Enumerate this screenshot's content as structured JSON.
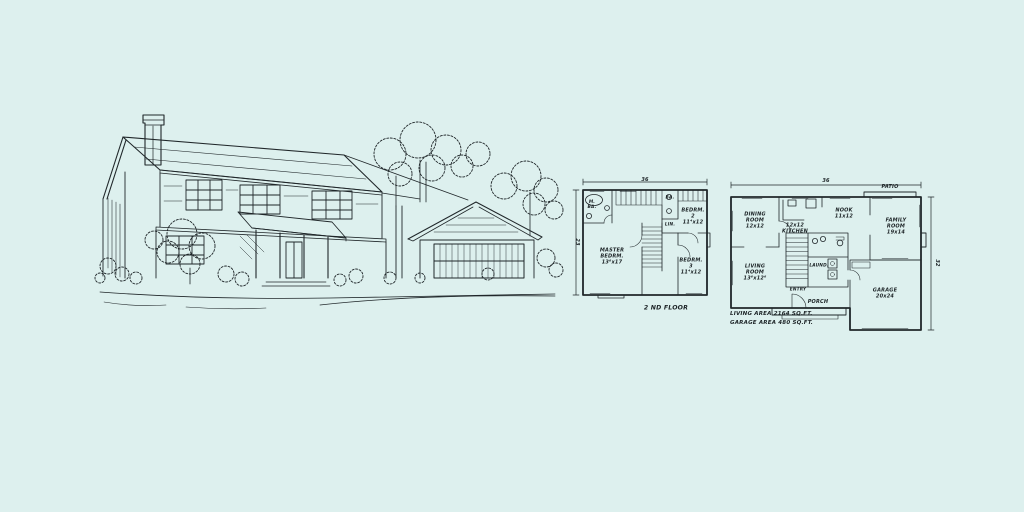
{
  "sheet": {
    "background_color": "#ddf0ee",
    "ink_color": "#20272a",
    "illustration_alt": "Pen-and-ink rendering of a two-story wood-sided house with tall chimney, covered entry porch, attached gabled two-car garage, surrounded by trees and shrubs with a curved driveway"
  },
  "second_floor_plan": {
    "title": "2 ND FLOOR",
    "dim_width": "36",
    "dim_depth": "23",
    "rooms": {
      "master_bath": "M.\nBA.",
      "bath": "BA.",
      "linen": "LIN.",
      "bedroom2": "BEDRM.\n2\n11⁴x12",
      "master_bedroom": "MASTER\nBEDRM.\n13⁶x17",
      "bedroom3": "BEDRM.\n3\n11⁴x12"
    }
  },
  "first_floor_plan": {
    "dim_width": "36",
    "dim_depth": "32",
    "rooms": {
      "patio": "PATIO",
      "dining_room": "DINING\nROOM\n12x12",
      "kitchen": "12x12\nKITCHEN",
      "nook": "NOOK\n11x12",
      "family_room": "FAMILY\nROOM\n19x14",
      "living_room": "LIVING\nROOM\n13⁶x12⁶",
      "laundry": "LAUND.",
      "entry": "ENTRY",
      "porch": "PORCH",
      "garage": "GARAGE\n20x24"
    },
    "notes": [
      "LIVING AREA 2164 SQ.FT.",
      "GARAGE AREA 480 SQ.FT."
    ]
  }
}
